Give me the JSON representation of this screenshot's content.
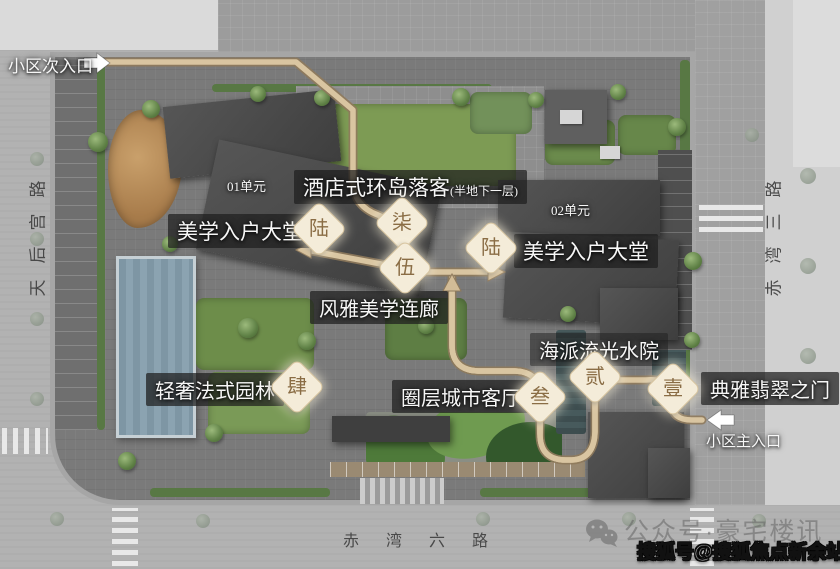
{
  "entrances": {
    "secondary_label": "小区次入口",
    "main_label": "小区主入口"
  },
  "roads": {
    "left": "天后宫路",
    "right": "赤湾三路",
    "bottom": "赤湾六路"
  },
  "buildings": {
    "unit01": "01单元",
    "unit02": "02单元"
  },
  "features": {
    "hotel_dropoff": "酒店式环岛落客",
    "hotel_dropoff_note": "(半地下一层)",
    "lobby_left": "美学入户大堂",
    "lobby_right": "美学入户大堂",
    "aesthetic_corridor": "风雅美学连廊",
    "water_courtyard": "海派流光水院",
    "french_garden": "轻奢法式园林",
    "city_living_room": "圈层城市客厅",
    "jade_gate": "典雅翡翠之门"
  },
  "badges": {
    "1": "壹",
    "2": "贰",
    "3": "叁",
    "4": "肆",
    "5": "伍",
    "6": "陆",
    "7": "柒"
  },
  "tour_stops": [
    {
      "num": "壹",
      "feature": "典雅翡翠之门"
    },
    {
      "num": "贰",
      "feature": "海派流光水院"
    },
    {
      "num": "叁",
      "feature": "圈层城市客厅"
    },
    {
      "num": "肆",
      "feature": "轻奢法式园林"
    },
    {
      "num": "伍",
      "feature": "风雅美学连廊"
    },
    {
      "num": "陆",
      "feature": "美学入户大堂"
    },
    {
      "num": "柒",
      "feature": "酒店式环岛落客"
    }
  ],
  "watermarks": {
    "wechat_account": "公众号·豪宅楼讯",
    "sohu_account": "搜狐号@搜狐焦点新余站"
  },
  "colors": {
    "badge_bg": "#f4ecd9",
    "badge_text": "#8a6d45",
    "route": "#d9c5a1",
    "route_edge": "#8f7a5c",
    "label_bg": "rgba(30,30,30,0.72)",
    "water": "#7e96a4"
  }
}
